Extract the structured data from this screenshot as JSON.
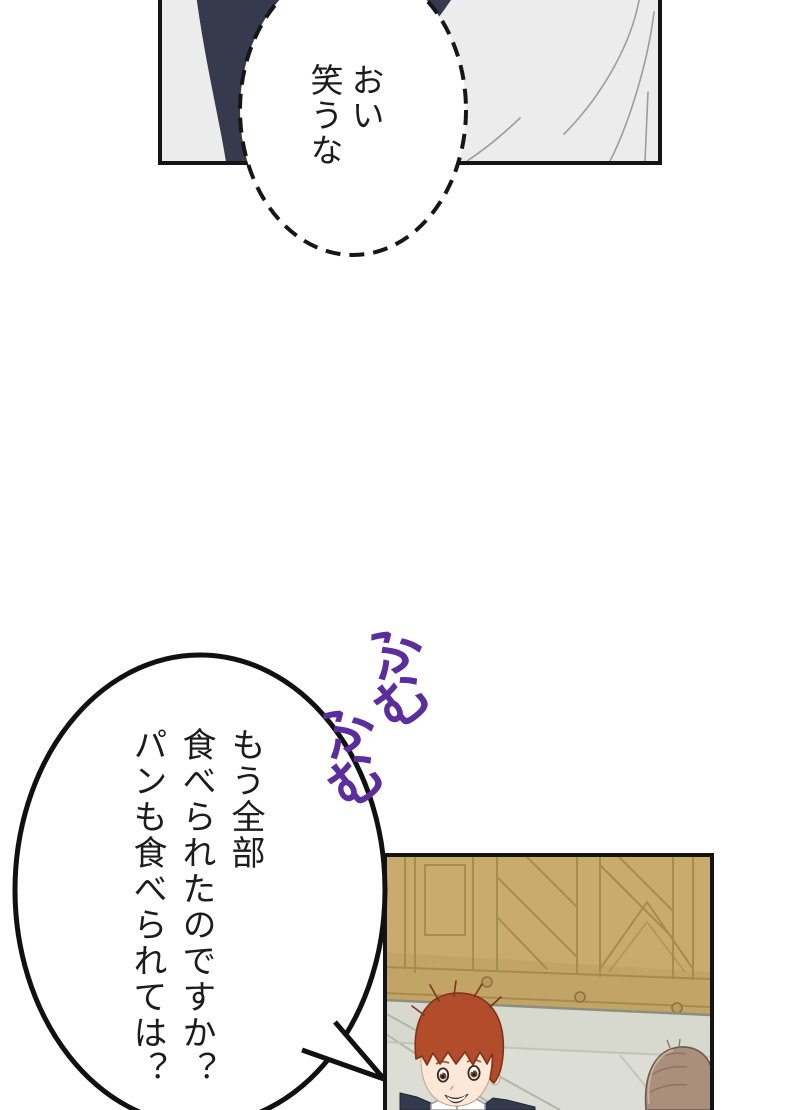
{
  "page": {
    "background": "#ffffff",
    "width": 800,
    "height": 1110
  },
  "panels": {
    "top": {
      "background": "#ececec",
      "border_color": "#141414"
    },
    "bottom": {
      "background": "#dcded5",
      "border_color": "#141414"
    }
  },
  "bubbles": {
    "whisper": {
      "style": "dashed-ellipse",
      "columns": [
        "おい",
        "笑うな"
      ]
    },
    "question": {
      "style": "solid-oval-with-tail",
      "columns": [
        "もう全部",
        "食べられたのですか？",
        "パンも食べられては？"
      ]
    }
  },
  "sfx": {
    "chars": [
      "ふ",
      "む",
      "ふ",
      "む"
    ],
    "color": "#5c2e9d"
  },
  "art": {
    "colors": {
      "ink": "#141414",
      "dark_garment": "#363a4c",
      "fabric_fold_line": "#9d9d9d",
      "wood_door": "#c9ab6e",
      "wood_line": "#a18749",
      "floor": "#dcded5",
      "hair_red": "#b24c2a",
      "hair_brown": "#a98f7c",
      "skin": "#fce8d9",
      "jacket_navy": "#353b4f"
    }
  }
}
